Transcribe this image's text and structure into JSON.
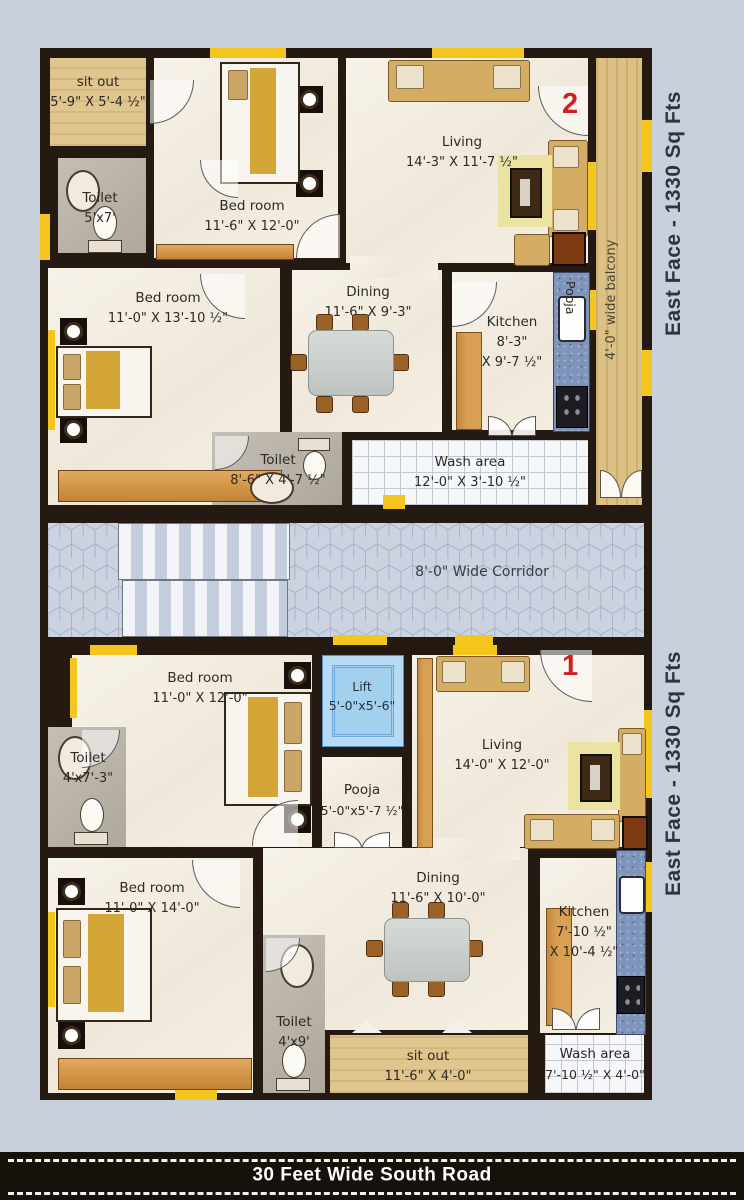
{
  "side": {
    "top_label": "East Face - 1330 Sq Fts",
    "bottom_label": "East Face - 1330 Sq Fts"
  },
  "road": {
    "label": "30 Feet Wide South Road"
  },
  "corridor": {
    "label": "8'-0\" Wide Corridor"
  },
  "balcony": {
    "label": "4'-0\" wide balcony"
  },
  "markers": {
    "top_unit": "2",
    "bottom_unit": "1"
  },
  "rooms": {
    "u2_sitout": {
      "name": "sit out",
      "dims": "5'-9\" X 5'-4 ½\""
    },
    "u2_toilet_a": {
      "name": "Toilet",
      "dims": "5'x7'"
    },
    "u2_bed_a": {
      "name": "Bed room",
      "dims": "11'-6\" X 12'-0\""
    },
    "u2_living": {
      "name": "Living",
      "dims": "14'-3\" X 11'-7 ½\""
    },
    "u2_bed_b": {
      "name": "Bed room",
      "dims": "11'-0\" X 13'-10 ½\""
    },
    "u2_dining": {
      "name": "Dining",
      "dims": "11'-6\" X 9'-3\""
    },
    "u2_kitchen": {
      "name": "Kitchen",
      "dims1": "8'-3\"",
      "dims2": "X 9'-7 ½\""
    },
    "u2_pooja": {
      "name": "Pooja"
    },
    "u2_toilet_b": {
      "name": "Toilet",
      "dims": "8'-6\" X 4'-7 ½\""
    },
    "u2_wash": {
      "name": "Wash area",
      "dims": "12'-0\" X 3'-10 ½\""
    },
    "u1_bed_a": {
      "name": "Bed room",
      "dims": "11'-0\" X 12'-0\""
    },
    "u1_lift": {
      "name": "Lift",
      "dims": "5'-0\"x5'-6\""
    },
    "u1_pooja": {
      "name": "Pooja",
      "dims": "5'-0\"x5'-7 ½\""
    },
    "u1_toilet_a": {
      "name": "Toilet",
      "dims": "4'x7'-3\""
    },
    "u1_living": {
      "name": "Living",
      "dims": "14'-0\" X 12'-0\""
    },
    "u1_bed_b": {
      "name": "Bed room",
      "dims": "11'-0\" X 14'-0\""
    },
    "u1_toilet_b": {
      "name": "Toilet",
      "dims": "4'x9'"
    },
    "u1_dining": {
      "name": "Dining",
      "dims": "11'-6\" X 10'-0\""
    },
    "u1_kitchen": {
      "name": "Kitchen",
      "dims1": "7'-10 ½\"",
      "dims2": "X 10'-4 ½\""
    },
    "u1_sitout": {
      "name": "sit out",
      "dims": "11'-6\" X 4'-0\""
    },
    "u1_wash": {
      "name": "Wash area",
      "dims": "7'-10 ½\" X 4'-0\""
    }
  },
  "colors": {
    "wall": "#241a11",
    "window_yellow": "#f4c51d",
    "floor_cream": "#f3eee4",
    "wood_tan": "#dcc186",
    "toilet_gray": "#b7b0a4",
    "counter_blue": "#7f94ba",
    "lift_blue": "#b7dbf4",
    "corridor_floor": "#ccd3e0",
    "marker_red": "#d01f1f",
    "road_bg": "#17110b",
    "background": "#c9d0dd"
  }
}
